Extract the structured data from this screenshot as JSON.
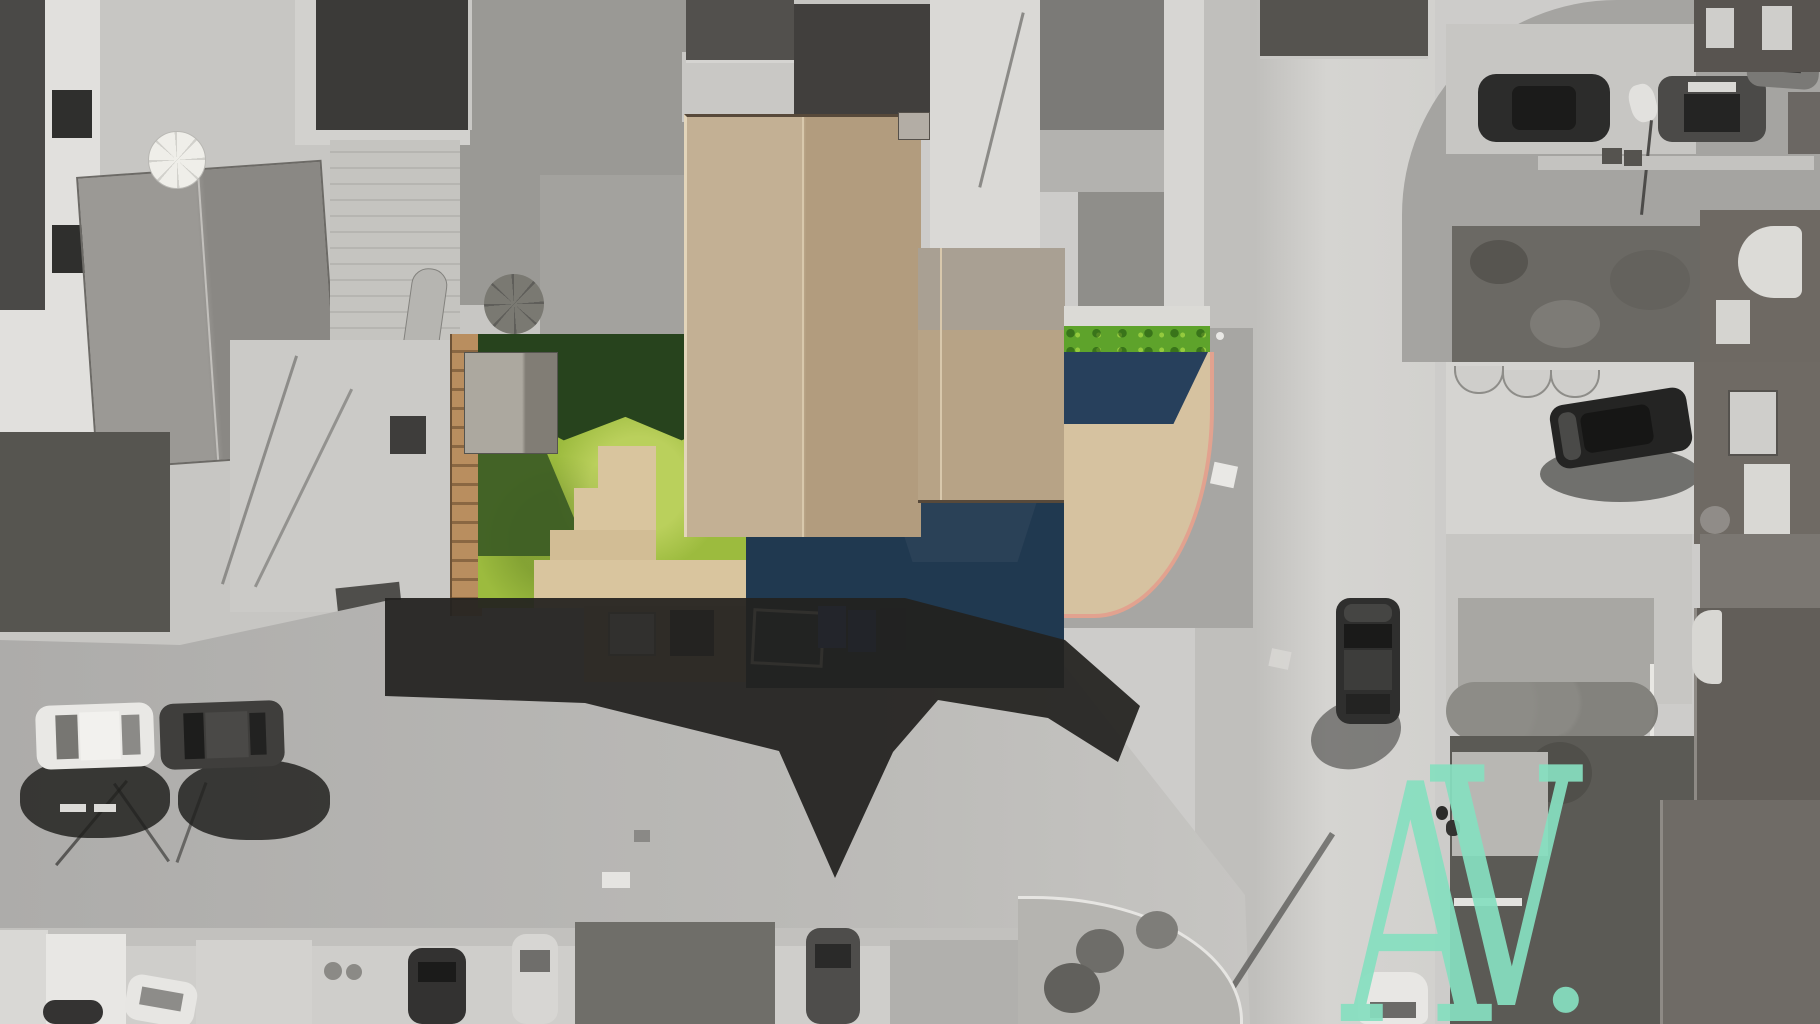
{
  "image": {
    "kind": "aerial drone photograph of a suburban residential street",
    "style": "black-and-white photo with selective colour highlighting one property",
    "width_px": "1820",
    "height_px": "1024"
  },
  "watermark": {
    "text": "AV.",
    "letter_a": "A",
    "letter_v": "V",
    "period": ".",
    "color": "#87dfc0"
  },
  "palette": {
    "paper_base": "#cdccca",
    "road_shaded": "#aaa9a6",
    "road_sunlit": "#d7d6d3",
    "asphalt_apron": "#a7a6a3",
    "deep_shadow": "#22211f",
    "lawn_green": "#9cbb3e",
    "lawn_shadow_green": "#27431d",
    "hedge_green": "#5ea32b",
    "roof_tan_light": "#c3b094",
    "roof_tan_dark": "#b29c7e",
    "driveway_tan": "#d6c2a0",
    "curb_pink": "#e2a28f",
    "conservatory_blue": "#4f86c8",
    "backyard_shadow_blue": "#203950",
    "bin_blue": "#2b58c6",
    "watermark_mint": "#87dfc0"
  },
  "scene": {
    "features": [
      "grayscale suburban rooftops and gardens",
      "selective-colour subject property with green lawn",
      "tan tiled house roof with rear wing",
      "blue conservatory roof",
      "block-paved tan driveway with pink curb and green hedge",
      "T-junction of residential roads",
      "large cast shadow of subject house on road",
      "parked cars and one car driving on main road",
      "pedestrian with long shadow on far sidewalk",
      "mint AV watermark bottom right"
    ],
    "visible_cars": "12",
    "pedestrians": "1",
    "umbrellas": "2"
  }
}
